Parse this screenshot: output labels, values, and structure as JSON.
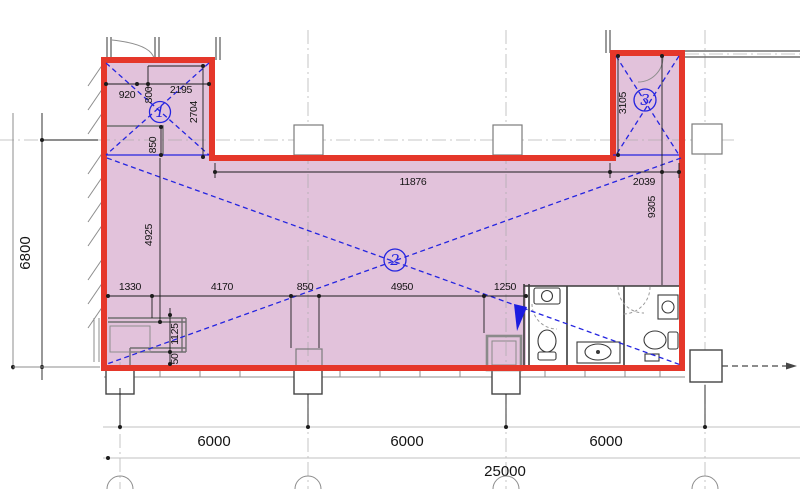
{
  "drawing": {
    "type": "architectural-floor-plan"
  },
  "grid_dims": {
    "bays": [
      "6000",
      "6000",
      "6000"
    ],
    "total": "25000",
    "left_height": "6800"
  },
  "interior_dims": {
    "top_main": "11876",
    "top_right": "2039",
    "right_height": "9305",
    "z1_a": "920",
    "z1_b": "800",
    "z1_c": "2195",
    "z1_d": "2704",
    "z1_e": "850",
    "z3_h": "3105",
    "left_v": "4925",
    "bottom": [
      "1330",
      "4170",
      "850",
      "4950",
      "1250"
    ],
    "v_a": "1125",
    "v_b": "50"
  },
  "zones": [
    {
      "id": "1"
    },
    {
      "id": "2"
    },
    {
      "id": "3"
    }
  ],
  "colors": {
    "wall_red": "#e5372a",
    "area_pink": "#e2c2db",
    "annotation_blue": "#2424e0"
  }
}
